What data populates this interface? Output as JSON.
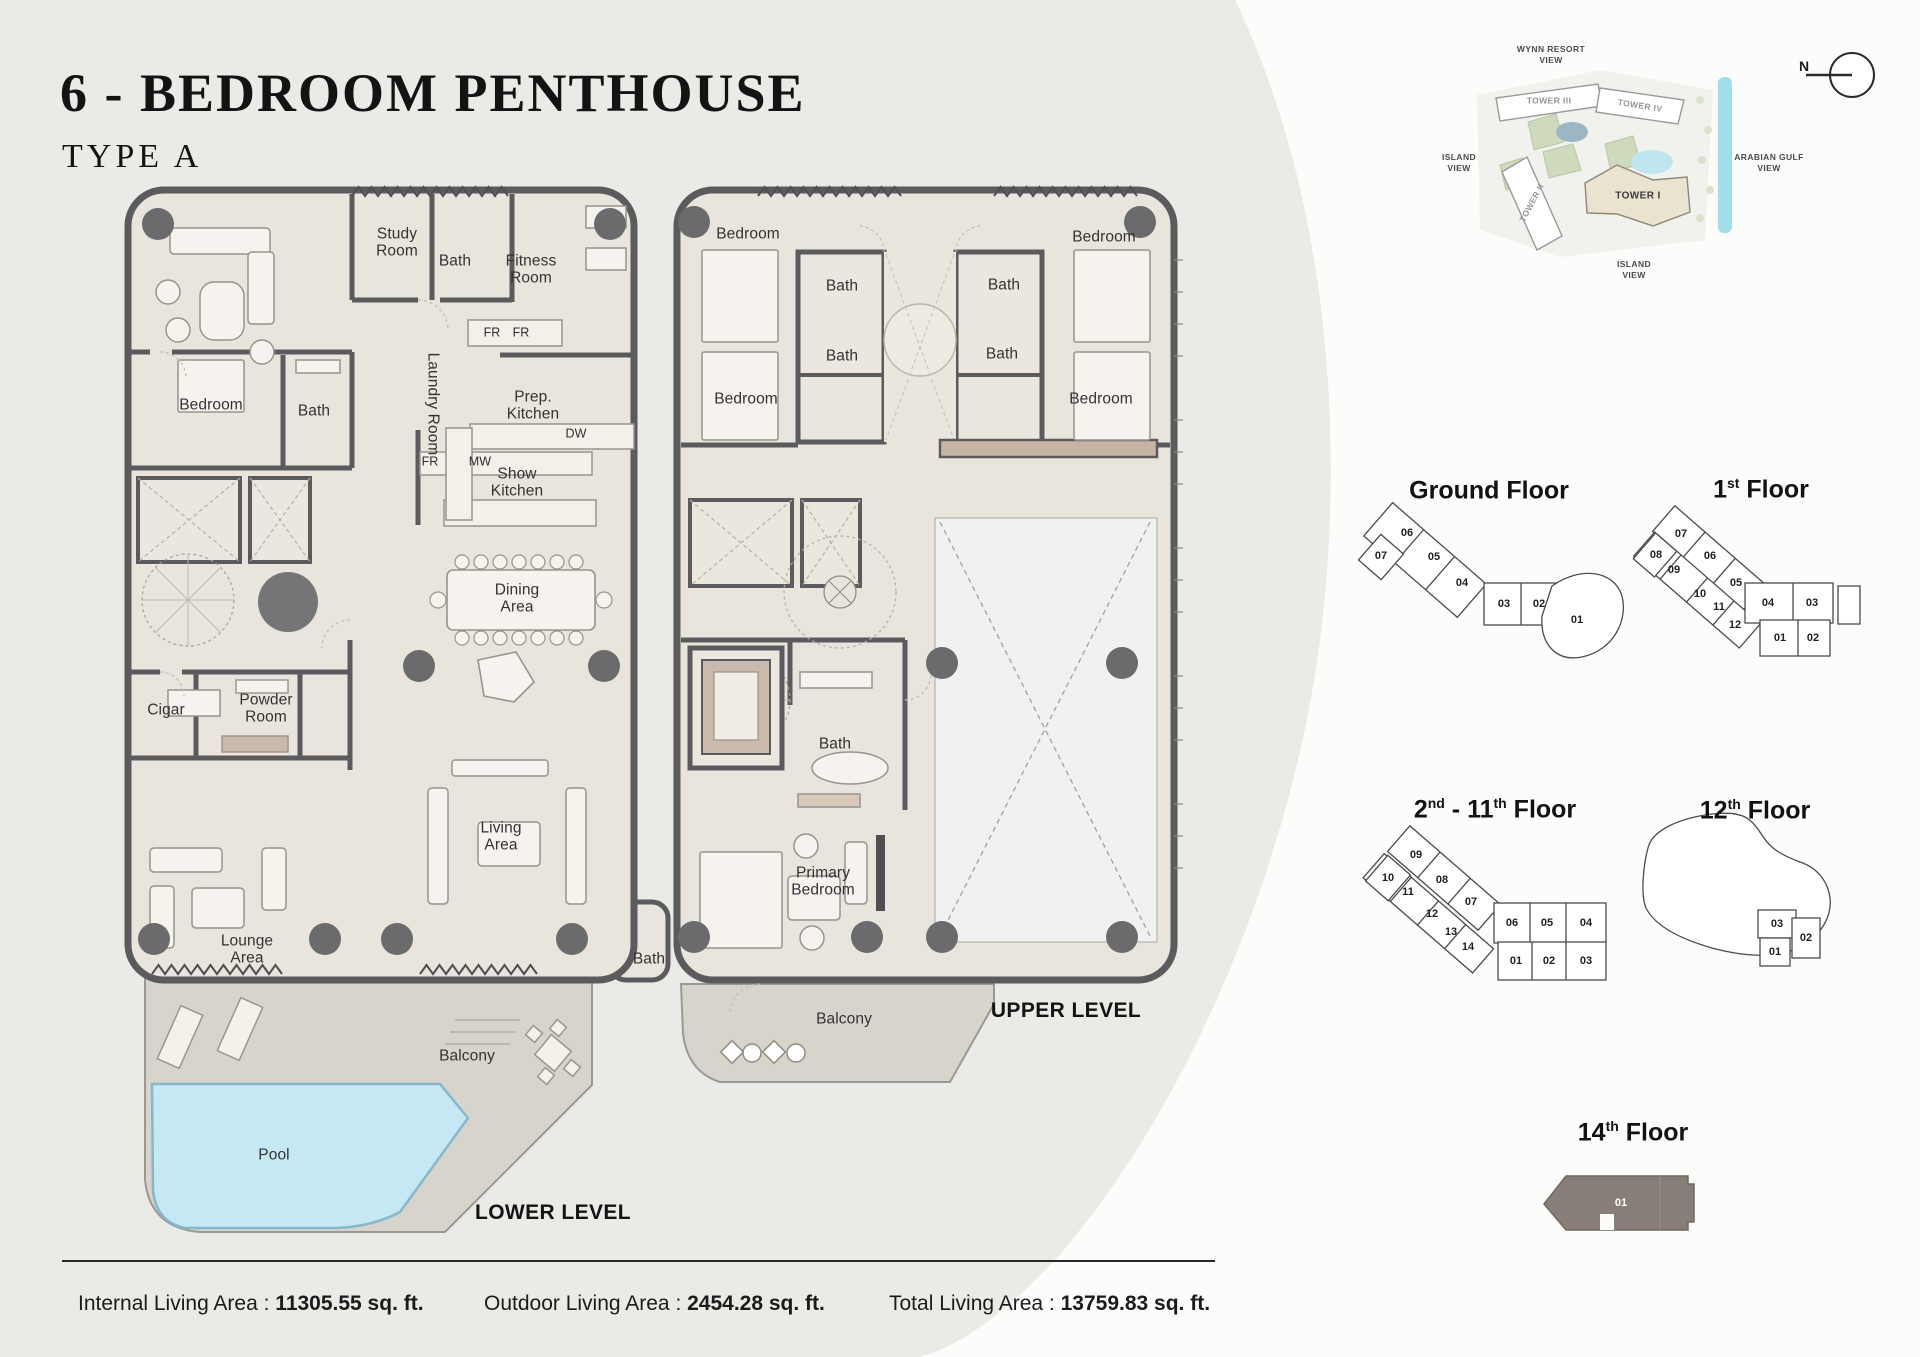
{
  "header": {
    "title": "6 - BEDROOM PENTHOUSE",
    "subtitle": "TYPE A"
  },
  "levels": {
    "lower": "LOWER LEVEL",
    "upper": "UPPER LEVEL"
  },
  "colors": {
    "plan_floor": "#eae5dc",
    "wall": "#5b5a5c",
    "pool": "#c5e8f4",
    "terrace": "#d7d4cc",
    "highlight_unit": "#877e77"
  },
  "lower_rooms": [
    {
      "label": "Study Room"
    },
    {
      "label": "Bath"
    },
    {
      "label": "Fitness Room"
    },
    {
      "label": "Bedroom"
    },
    {
      "label": "Bath"
    },
    {
      "label": "Laundry Room"
    },
    {
      "label": "FR"
    },
    {
      "label": "FR"
    },
    {
      "label": "Prep. Kitchen"
    },
    {
      "label": "FR"
    },
    {
      "label": "MW"
    },
    {
      "label": "DW"
    },
    {
      "label": "Show Kitchen"
    },
    {
      "label": "Dining Area"
    },
    {
      "label": "Cigar"
    },
    {
      "label": "Powder Room"
    },
    {
      "label": "Living Area"
    },
    {
      "label": "Lounge Area"
    },
    {
      "label": "Bath"
    },
    {
      "label": "Balcony"
    },
    {
      "label": "Pool"
    }
  ],
  "upper_rooms": [
    {
      "label": "Bedroom"
    },
    {
      "label": "Bath"
    },
    {
      "label": "Bath"
    },
    {
      "label": "Bedroom"
    },
    {
      "label": "Bath"
    },
    {
      "label": "Bath"
    },
    {
      "label": "Bedroom"
    },
    {
      "label": "Bedroom"
    },
    {
      "label": "Bath"
    },
    {
      "label": "Primary Bedroom"
    },
    {
      "label": "Balcony"
    }
  ],
  "site_map": {
    "labels": [
      {
        "text": "WYNN RESORT\nVIEW"
      },
      {
        "text": "TOWER III"
      },
      {
        "text": "TOWER IV"
      },
      {
        "text": "ISLAND\nVIEW"
      },
      {
        "text": "ARABIAN GULF\nVIEW"
      },
      {
        "text": "TOWER II"
      },
      {
        "text": "TOWER I"
      },
      {
        "text": "ISLAND\nVIEW"
      }
    ],
    "compass_n": "N"
  },
  "key_plans": {
    "ground": {
      "title": "Ground Floor",
      "units": [
        "06",
        "07",
        "05",
        "04",
        "03",
        "02",
        "01"
      ]
    },
    "first": {
      "title_a": "1",
      "title_sup": "st",
      "title_b": " Floor",
      "units": [
        "07",
        "08",
        "09",
        "06",
        "10",
        "05",
        "11",
        "12",
        "04",
        "03",
        "01",
        "02"
      ]
    },
    "mid": {
      "title_a": "2",
      "title_sup_a": "nd",
      "title_b": " - 11",
      "title_sup_b": "th",
      "title_c": " Floor",
      "units": [
        "09",
        "10",
        "08",
        "11",
        "07",
        "12",
        "13",
        "14",
        "06",
        "05",
        "04",
        "01",
        "02",
        "03"
      ]
    },
    "twelfth": {
      "title_a": "12",
      "title_sup": "th",
      "title_b": " Floor",
      "units": [
        "03",
        "02",
        "01"
      ]
    },
    "fourteenth": {
      "title_a": "14",
      "title_sup": "th",
      "title_b": " Floor",
      "units": [
        "01"
      ]
    }
  },
  "footer": {
    "areas": [
      {
        "label": "Internal Living Area : ",
        "value": "11305.55 sq. ft."
      },
      {
        "label": "Outdoor Living Area : ",
        "value": "2454.28 sq. ft."
      },
      {
        "label": "Total Living Area : ",
        "value": "13759.83 sq. ft."
      }
    ]
  }
}
